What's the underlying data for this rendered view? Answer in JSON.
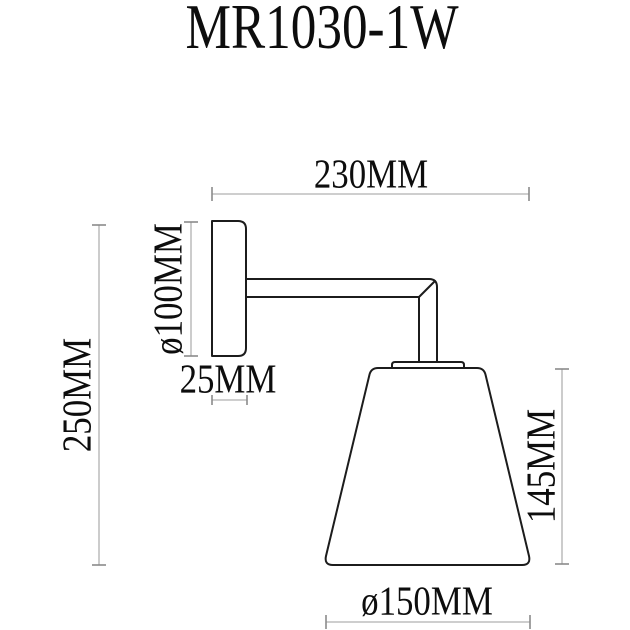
{
  "title": "MR1030-1W",
  "diagram": {
    "product_type": "wall-lamp-dimension-drawing",
    "labels": {
      "depth_total": "230MM",
      "backplate_diameter": "ø100MM",
      "backplate_thickness": "25MM",
      "height_total": "250MM",
      "shade_height": "145MM",
      "shade_diameter": "ø150MM"
    },
    "colors": {
      "outline": "#1c1c1c",
      "dimension_line": "#b0b0b0",
      "dimension_tick": "#8a8a8a",
      "text": "#0d0d0d",
      "background": "#ffffff"
    }
  }
}
